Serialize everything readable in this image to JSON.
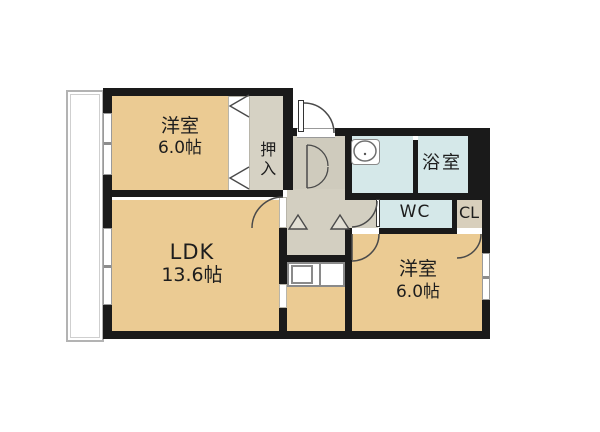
{
  "plan_type": "apartment-floor-plan",
  "rooms": {
    "western1": {
      "name": "洋室",
      "area": "6.0帖"
    },
    "ldk": {
      "name": "LDK",
      "area": "13.6帖"
    },
    "western2": {
      "name": "洋室",
      "area": "6.0帖"
    },
    "oshiire": {
      "name": "押入"
    },
    "bath": {
      "name": "浴室"
    },
    "wc": {
      "name": "WC"
    },
    "closet": {
      "name": "CL"
    }
  },
  "colors": {
    "wall": "#1a1a1a",
    "room_tan": "#ebcb93",
    "hall_gray": "#d3cfc1",
    "wet_cyan": "#d5e8e9",
    "closet_beige": "#d8cfbc",
    "oshiire_gray": "#d6d2c4"
  },
  "fixtures": {
    "washbasin": "wash-basin",
    "kitchen_sink": "kitchen-sink",
    "entrance_door": "front-door-swing",
    "balcony": "balcony"
  }
}
